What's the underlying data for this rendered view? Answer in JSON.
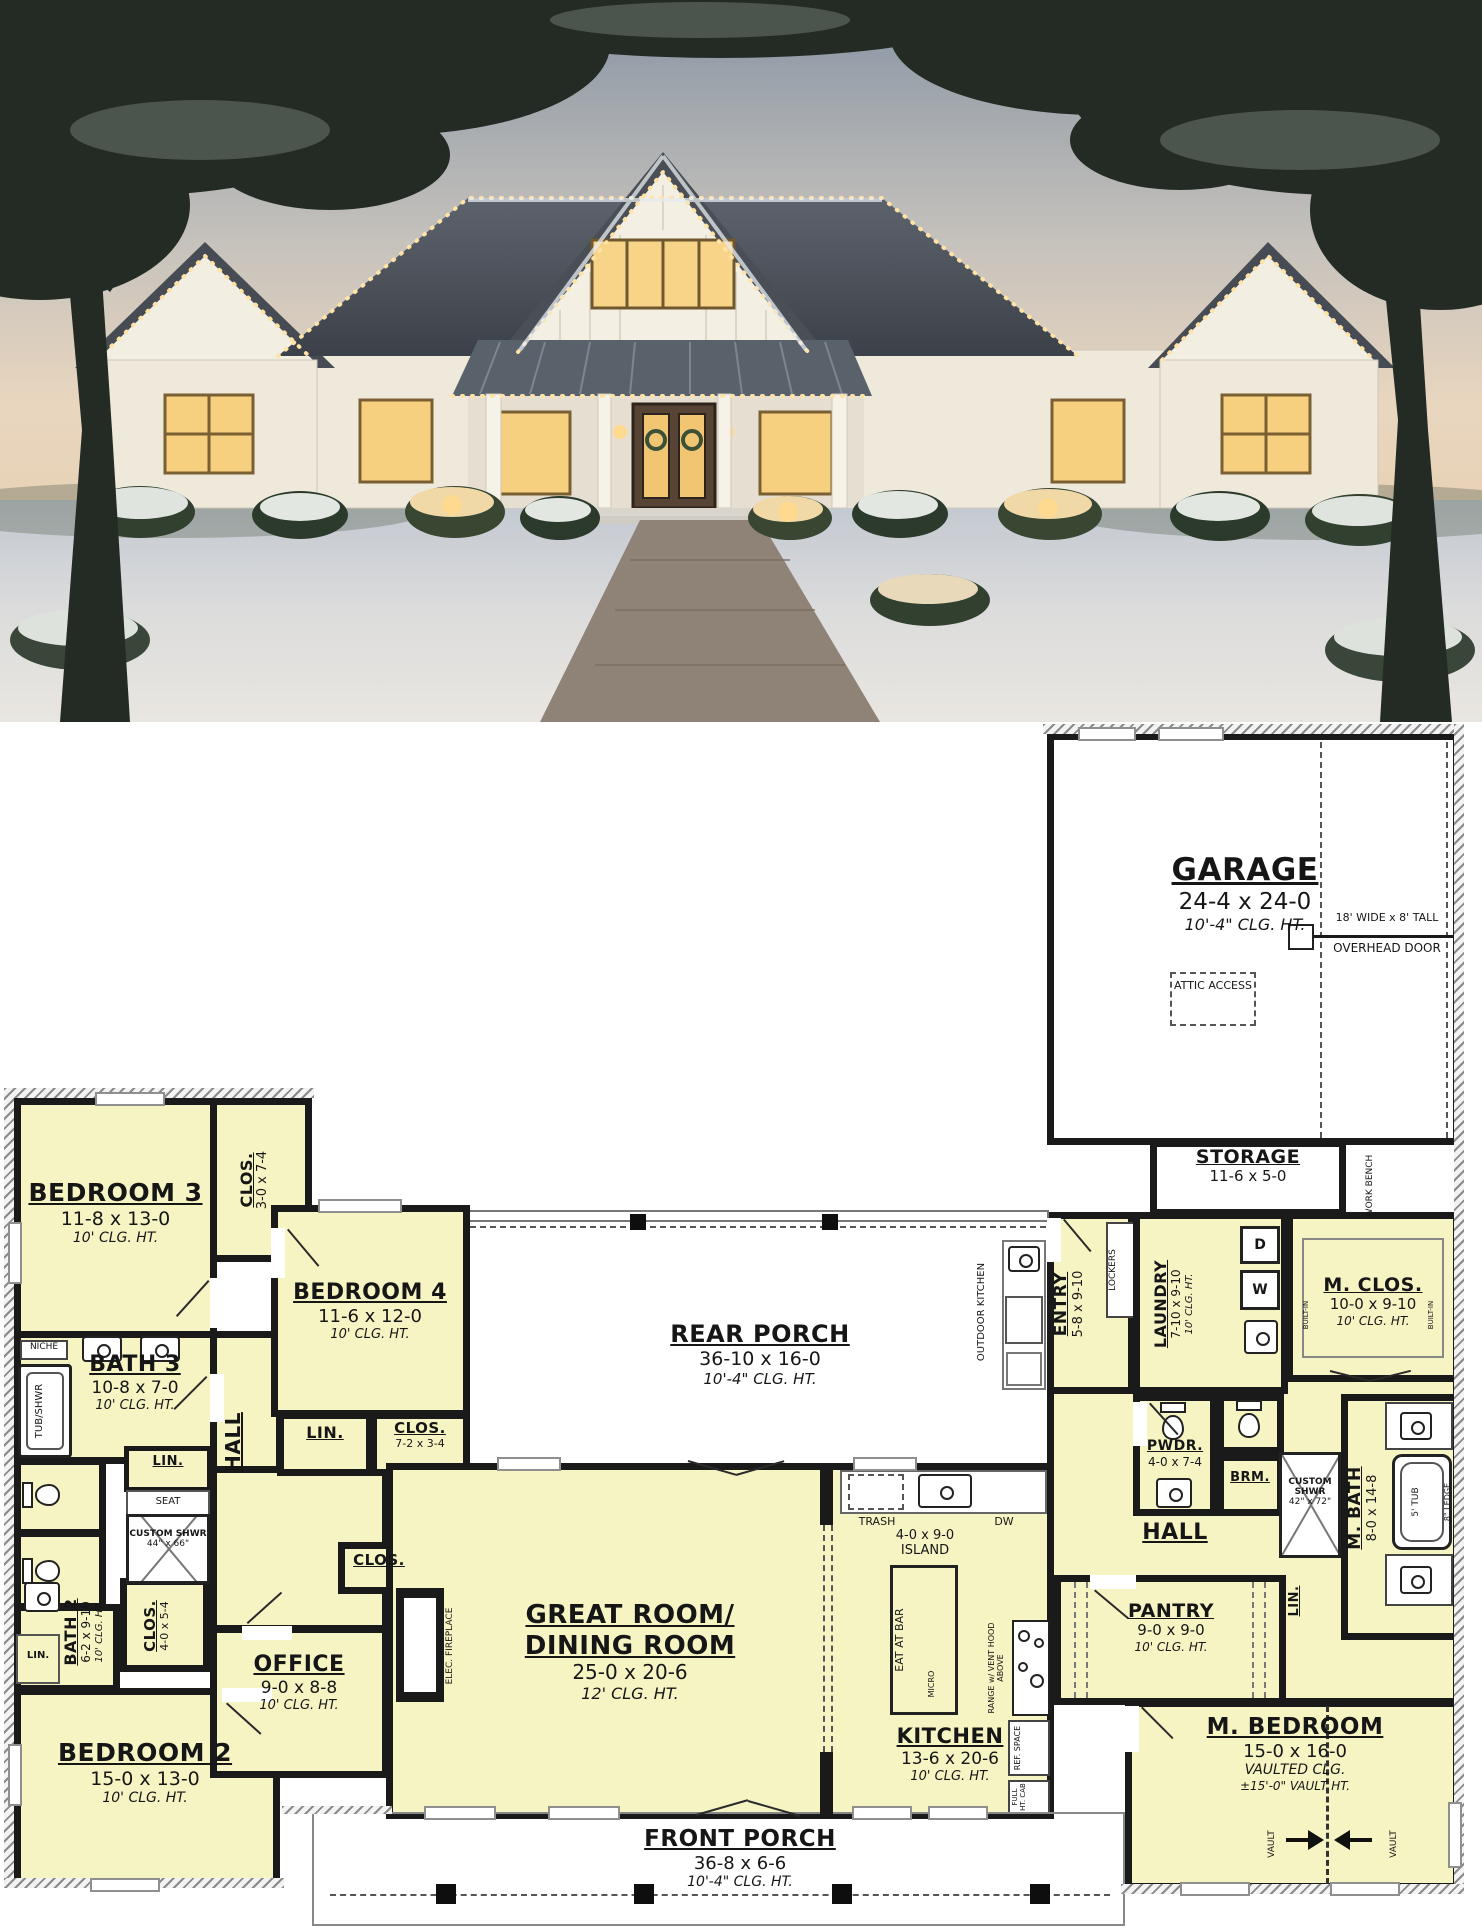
{
  "plan": {
    "rooms": {
      "garage": {
        "name": "GARAGE",
        "dims": "24-4 x 24-0",
        "clg": "10'-4\" CLG. HT."
      },
      "storage": {
        "name": "STORAGE",
        "dims": "11-6 x 5-0"
      },
      "rear_porch": {
        "name": "REAR PORCH",
        "dims": "36-10 x 16-0",
        "clg": "10'-4\" CLG. HT."
      },
      "front_porch": {
        "name": "FRONT PORCH",
        "dims": "36-8 x 6-6",
        "clg": "10'-4\" CLG. HT."
      },
      "great_room": {
        "name_line1": "GREAT ROOM/",
        "name_line2": "DINING ROOM",
        "dims": "25-0 x 20-6",
        "clg": "12' CLG. HT."
      },
      "kitchen": {
        "name": "KITCHEN",
        "dims": "13-6 x 20-6",
        "clg": "10' CLG. HT."
      },
      "pantry": {
        "name": "PANTRY",
        "dims": "9-0 x 9-0",
        "clg": "10' CLG. HT."
      },
      "office": {
        "name": "OFFICE",
        "dims": "9-0 x 8-8",
        "clg": "10' CLG. HT."
      },
      "master_bedroom": {
        "name": "M. BEDROOM",
        "dims": "15-0 x 16-0",
        "clg": "VAULTED CLG.",
        "vault": "±15'-0\" VAULT HT."
      },
      "master_bath": {
        "name": "M. BATH",
        "dims": "8-0 x 14-8"
      },
      "master_closet": {
        "name": "M. CLOS.",
        "dims": "10-0 x 9-10",
        "clg": "10' CLG. HT."
      },
      "bedroom2": {
        "name": "BEDROOM 2",
        "dims": "15-0 x 13-0",
        "clg": "10' CLG. HT."
      },
      "bedroom3": {
        "name": "BEDROOM 3",
        "dims": "11-8 x 13-0",
        "clg": "10' CLG. HT."
      },
      "bedroom4": {
        "name": "BEDROOM 4",
        "dims": "11-6 x 12-0",
        "clg": "10' CLG. HT."
      },
      "bath2": {
        "name": "BATH 2",
        "dims": "6-2 x 9-10",
        "clg": "10' CLG. HT."
      },
      "bath3": {
        "name": "BATH 3",
        "dims": "10-8 x 7-0",
        "clg": "10' CLG. HT."
      },
      "laundry": {
        "name": "LAUNDRY",
        "dims": "7-10 x 9-10",
        "clg": "10' CLG. HT."
      },
      "entry": {
        "name": "ENTRY",
        "dims": "5-8 x 9-10"
      },
      "powder": {
        "name": "PWDR.",
        "dims": "4-0 x 7-4"
      },
      "hall": {
        "name": "HALL"
      },
      "closet_bed3": {
        "name": "CLOS.",
        "dims": "3-0 x 7-4"
      },
      "closet_hall": {
        "name": "CLOS.",
        "dims": "7-2 x 3-4"
      },
      "closet_bed2": {
        "name": "CLOS.",
        "dims": "4-0 x 5-4"
      },
      "closet_office": {
        "name": "CLOS."
      }
    },
    "annotations": {
      "overhead_door_size": "18' WIDE x 8' TALL",
      "overhead_door": "OVERHEAD DOOR",
      "attic_access": "ATTIC ACCESS",
      "work_bench": "WORK BENCH",
      "outdoor_kitchen": "OUTDOOR KITCHEN",
      "lockers": "LOCKERS",
      "built_in": "BUILT-IN",
      "dryer": "D",
      "washer": "W",
      "niche": "NICHE",
      "tub_shwr": "TUB/SHWR",
      "linen": "LIN.",
      "seat": "SEAT",
      "custom_shower": "CUSTOM SHWR",
      "custom_shower_size_hall": "44\" x 66\"",
      "custom_shower_size_master": "42\" x 72\"",
      "broom": "BRM.",
      "tub_5": "5' TUB",
      "ledge_8": "8\" LEDGE",
      "trash": "TRASH",
      "dishwasher": "DW",
      "island_dims": "4-0 x 9-0",
      "island": "ISLAND",
      "eat_at_bar": "EAT AT BAR",
      "range": "RANGE w/ VENT HOOD ABOVE",
      "micro": "MICRO",
      "ref_space": "REF. SPACE",
      "full_ht_cab": "FULL HT. CAB",
      "elec_fireplace": "ELEC. FIREPLACE",
      "vault": "VAULT"
    },
    "colors": {
      "room_fill": "#f7f4c4",
      "wall": "#1a1a1a",
      "paper": "#ffffff"
    }
  }
}
